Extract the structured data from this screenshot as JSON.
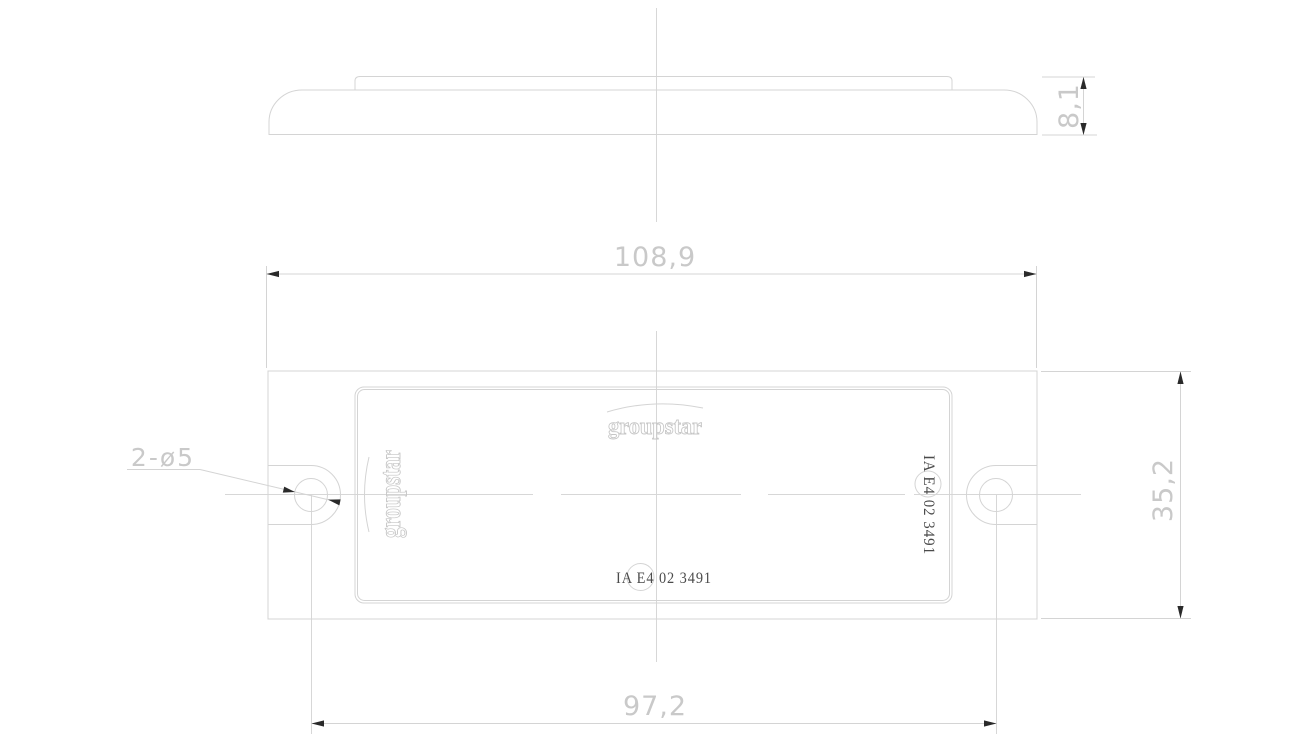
{
  "drawing": {
    "brand_logo": "groupstar",
    "approval_mark": "IA E4 02 3491",
    "dimensions": {
      "overall_width": "108,9",
      "hole_spacing": "97,2",
      "overall_height": "35,2",
      "depth": "8,1",
      "hole_callout": "2-ø5"
    },
    "colors": {
      "background": "#ffffff",
      "outline": "#d4d4d4",
      "dimension_text": "#c9c9c9",
      "arrowhead": "#2a2a2a",
      "marking_text": "#4b4b4b",
      "logo_outline": "#c6c6c6"
    }
  }
}
